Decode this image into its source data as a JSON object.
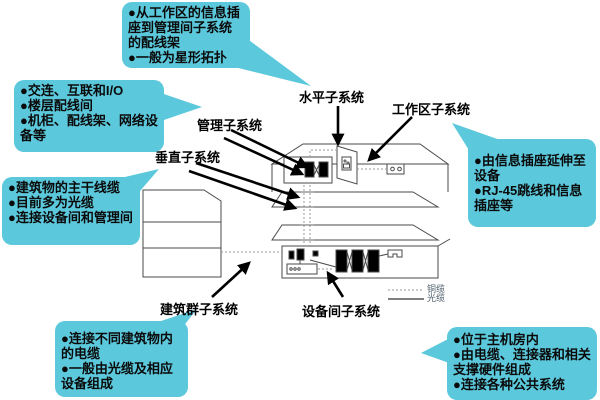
{
  "colors": {
    "callout_bg": "#5CC8DC",
    "arrow": "#000000",
    "building_line": "#4a4a4a",
    "copper_line": "#999999",
    "fiber_line": "#333333"
  },
  "labels": {
    "horizontal": "水平子系统",
    "work_area": "工作区子系统",
    "management": "管理子系统",
    "vertical": "垂直子系统",
    "campus": "建筑群子系统",
    "equipment_room": "设备间子系统"
  },
  "callouts": {
    "horizontal_notes": {
      "items": [
        "●从工作区的信息插座到管理间子系统的配线架",
        "●一般为星形拓扑"
      ]
    },
    "management_notes": {
      "items": [
        "●交连、互联和I/O",
        "●楼层配线间",
        "●机柜、配线架、网络设备等"
      ]
    },
    "vertical_notes": {
      "items": [
        "●建筑物的主干线缆",
        "●目前多为光缆",
        "●连接设备间和管理间"
      ]
    },
    "work_area_notes": {
      "items": [
        "●由信息插座延伸至设备",
        "●RJ-45跳线和信息插座等"
      ]
    },
    "campus_notes": {
      "items": [
        "●连接不同建筑物内的电缆",
        "●一般由光缆及相应设备组成"
      ]
    },
    "equipment_room_notes": {
      "items": [
        "●位于主机房内",
        "●由电缆、连接器和相关支撑硬件组成",
        "●连接各种公共系统"
      ]
    }
  },
  "legend": {
    "copper": "铜缆",
    "fiber": "光缆"
  }
}
